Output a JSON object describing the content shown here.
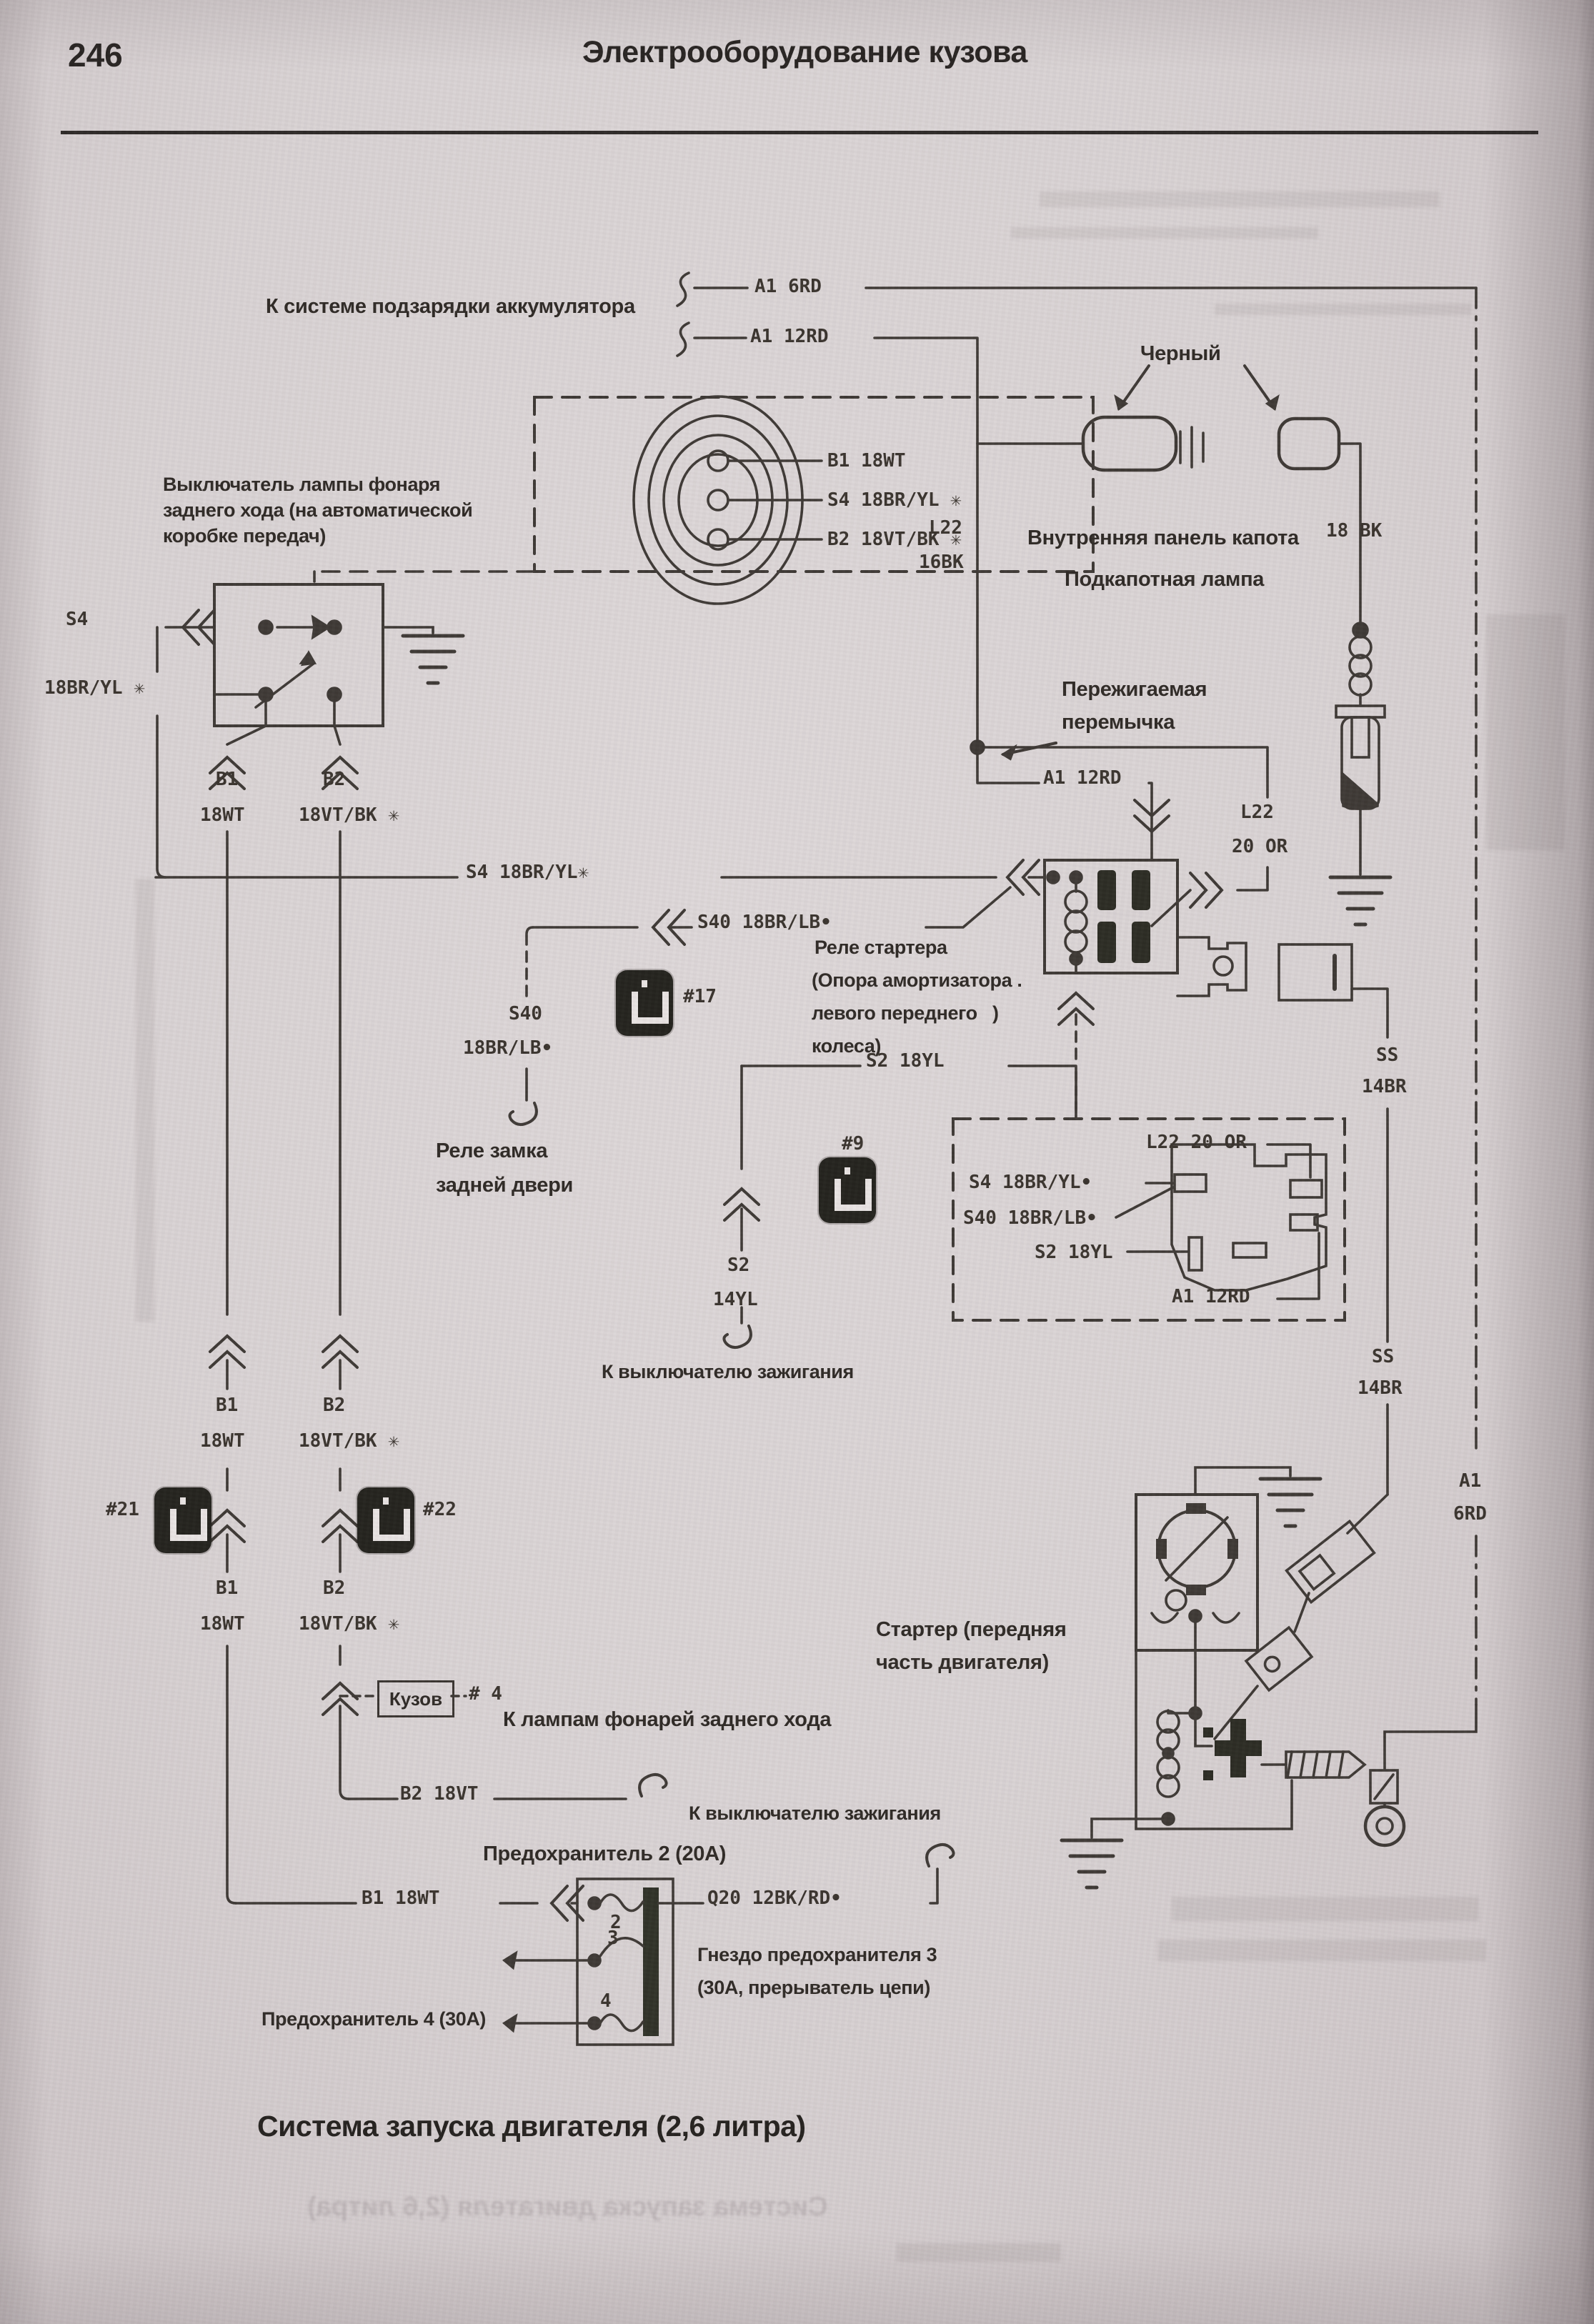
{
  "page": {
    "number": "246",
    "header": "Электрооборудование кузова"
  },
  "colors": {
    "paper": "#d8d2d3",
    "ink": "#3c3733",
    "chip": "#22211c",
    "accent_dark": "#23201d"
  },
  "diagram": {
    "caption": "Система запуска двигателя (2,6 литра)",
    "charge_system": "К системе подзарядки аккумулятора",
    "wire_a1_6rd": "A1 6RD",
    "wire_a1_12rd": "A1 12RD",
    "black_label": "Черный",
    "inner_hood_panel": "Внутренняя панель капота",
    "wire_18bk": "18 BK",
    "l22": "L22",
    "l22_gauge": "16BK",
    "hood_lamp": "Подкапотная лампа",
    "fusible_link_1": "Пережигаемая",
    "fusible_link_2": "перемычка",
    "reverse_switch_1": "Выключатель лампы фонаря",
    "reverse_switch_2": "заднего хода (на автоматической",
    "reverse_switch_3": "коробке передач)",
    "conn_pin_b1": "B1 18WT",
    "conn_pin_s4": "S4 18BR/YL ✳",
    "conn_pin_b2": "B2 18VT/BK ✳",
    "s4": "S4",
    "s4_gauge": "18BR/YL ✳",
    "b1": "B1",
    "b1_gauge": "18WT",
    "b2": "B2",
    "b2_gauge": "18VT/BK ✳",
    "s4_inline": "S4 18BR/YL✳",
    "s40_inline": "S40 18BR/LB•",
    "s40": "S40",
    "s40_gauge": "18BR/LB•",
    "starter_relay_1": "Реле стартера",
    "starter_relay_2": "(Опора амортизатора .",
    "starter_relay_3": "левого переднего   )",
    "starter_relay_4": "колеса)",
    "num17": "#17",
    "num9": "#9",
    "num21": "#21",
    "num22": "#22",
    "num4": "# 4",
    "rear_lock_relay_1": "Реле замка",
    "rear_lock_relay_2": "задней двери",
    "l22_20or_1": "L22",
    "l22_20or_2": "20 OR",
    "s2_inline": "S2 18YL",
    "s2": "S2",
    "s2_gauge": "14YL",
    "ss": "SS",
    "ss_gauge": "14BR",
    "box_l22": "L22 20 OR",
    "box_s4": "S4 18BR/YL•",
    "box_s40": "S40 18BR/LB•",
    "box_s2": "S2 18YL",
    "box_a1": "A1 12RD",
    "a1": "A1",
    "a1_gauge": "6RD",
    "to_ignition": "К выключателю зажигания",
    "starter_1": "Стартер (передняя",
    "starter_2": "часть двигателя)",
    "kuzov": "Кузов",
    "to_reverse_lamps": "К лампам фонарей заднего хода",
    "b2_18vt_inline": "B2 18VT",
    "fuse2": "Предохранитель 2 (20А)",
    "b1_inline": "B1 18WT",
    "q20_inline": "Q20 12BK/RD•",
    "fuse3_socket_1": "Гнездо предохранителя 3",
    "fuse3_socket_2": "(30А, прерыватель цепи)",
    "fuse4": "Предохранитель 4 (30А)",
    "fuse_num2": "2",
    "fuse_num3": "3",
    "fuse_num4": "4"
  }
}
